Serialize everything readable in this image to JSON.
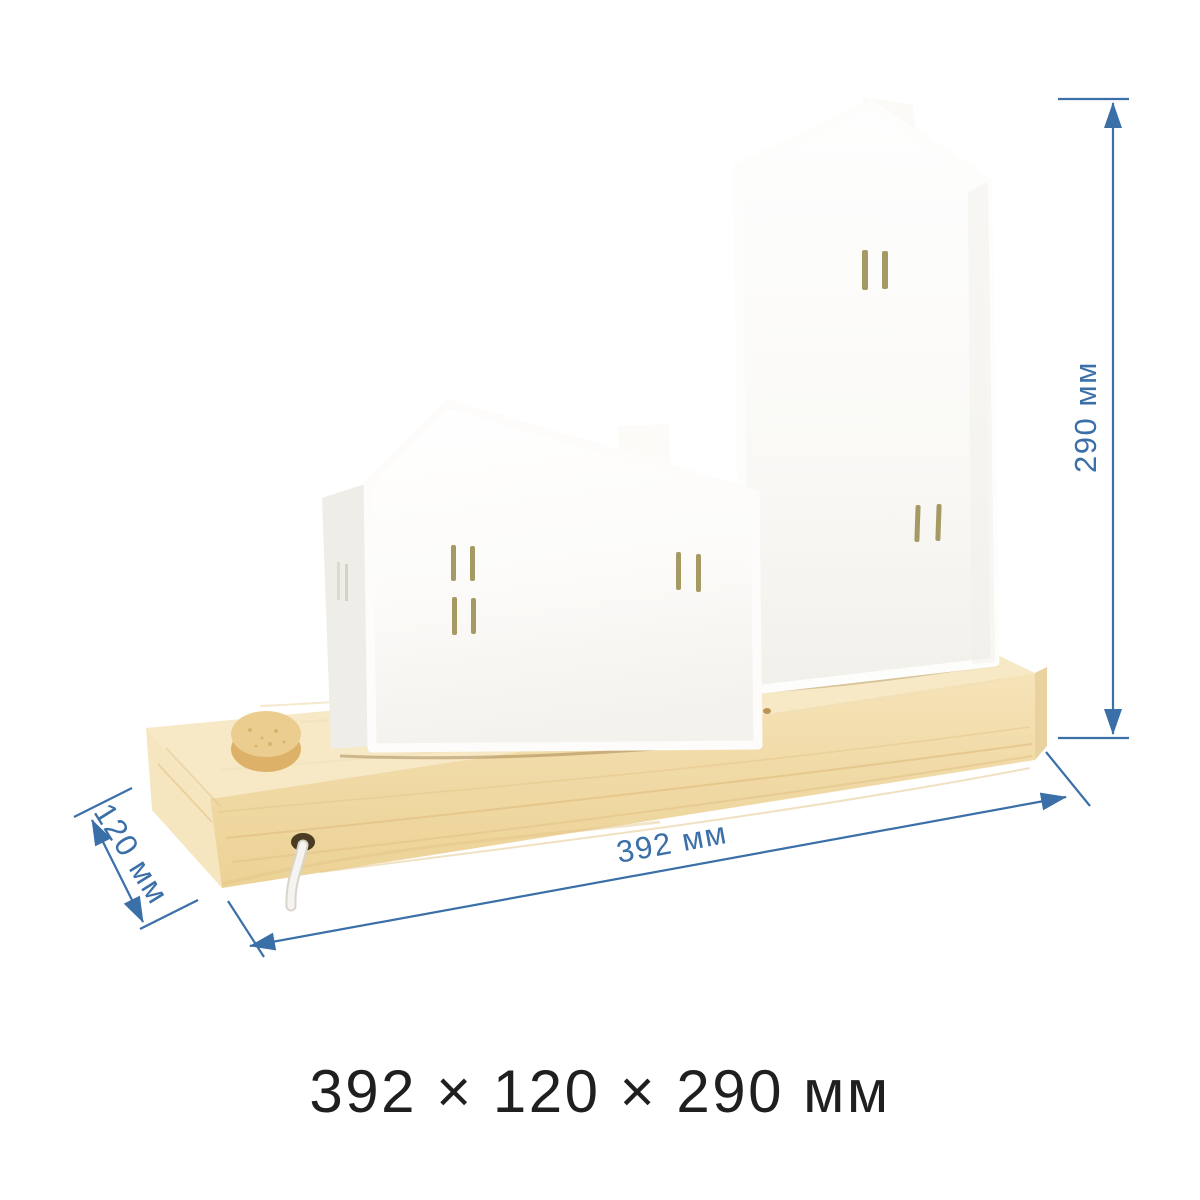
{
  "product_view": "white ceramic house night-light on wooden base, three-quarter view",
  "dimensions": {
    "width_mm": 392,
    "depth_mm": 120,
    "height_mm": 290,
    "width_label": "392 мм",
    "depth_label": "120 мм",
    "height_label": "290 мм",
    "summary_label": "392 × 120 × 290 мм"
  },
  "colors": {
    "accent": "#3a6fa8",
    "summary_text": "#1f1f1f",
    "background": "#ffffff",
    "wood_top": "#f7e8c6",
    "wood_front": "#f1dbaa",
    "wood_end": "#f6e6c0",
    "wood_grain": "#e3c387",
    "knob_top": "#eccd90",
    "knob_side": "#ddb268",
    "house_front": "#fdfdfb",
    "house_side": "#efede7",
    "window_slit": "#a69a64",
    "cord": "#f6f4f1"
  }
}
